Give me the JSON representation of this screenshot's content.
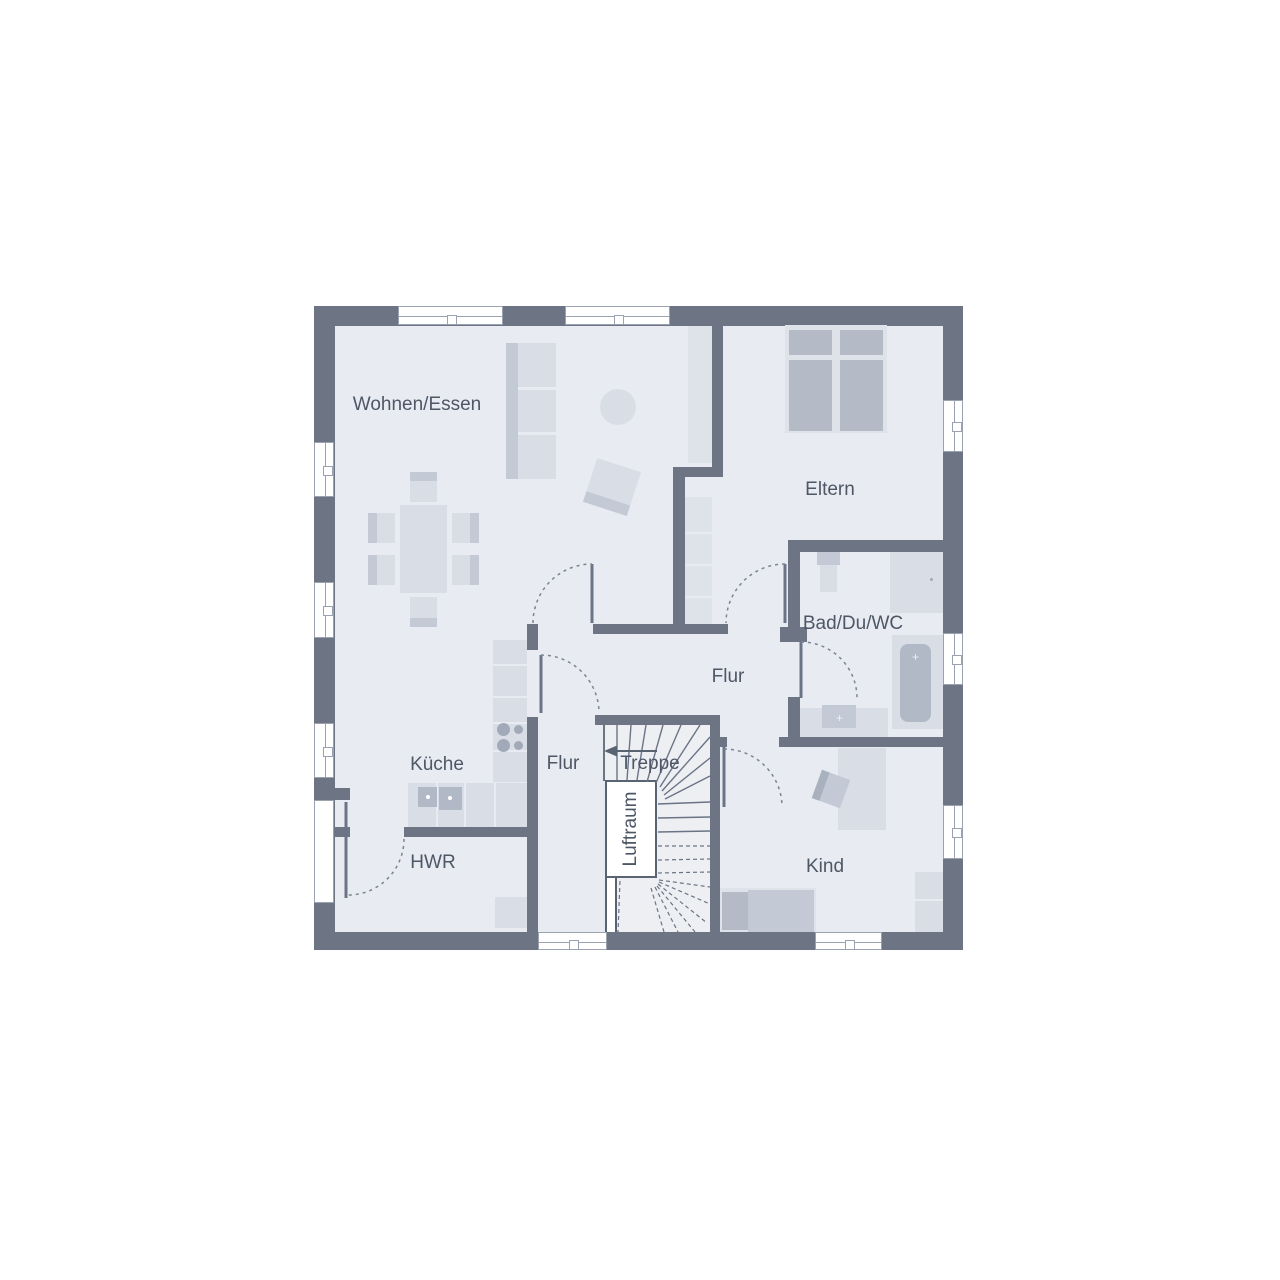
{
  "image_type": "architectural floor plan, upper storey, German room labels",
  "colors": {
    "background": "#ffffff",
    "wall": "#6d7585",
    "floor": "#e8ebf1",
    "stair_floor": "#edeff3",
    "furniture": "#d9dee6",
    "furniture_mid": "#c3cad6",
    "furniture_dark": "#b2b9c6",
    "bed_fill": "#b4bac6",
    "frame_light": "#dee2e9",
    "window_line": "#9aa2b0",
    "label_text": "#4e5766",
    "door_line": "#6b7486"
  },
  "rooms": {
    "living": {
      "label": "Wohnen/Essen"
    },
    "parents": {
      "label": "Eltern"
    },
    "bath": {
      "label": "Bad/Du/WC"
    },
    "hall_upper": {
      "label": "Flur"
    },
    "hall_lower": {
      "label": "Flur"
    },
    "kitchen": {
      "label": "Küche"
    },
    "stair": {
      "label": "Treppe"
    },
    "air_space": {
      "label": "Luftraum"
    },
    "utility": {
      "label": "HWR"
    },
    "child": {
      "label": "Kind"
    }
  }
}
